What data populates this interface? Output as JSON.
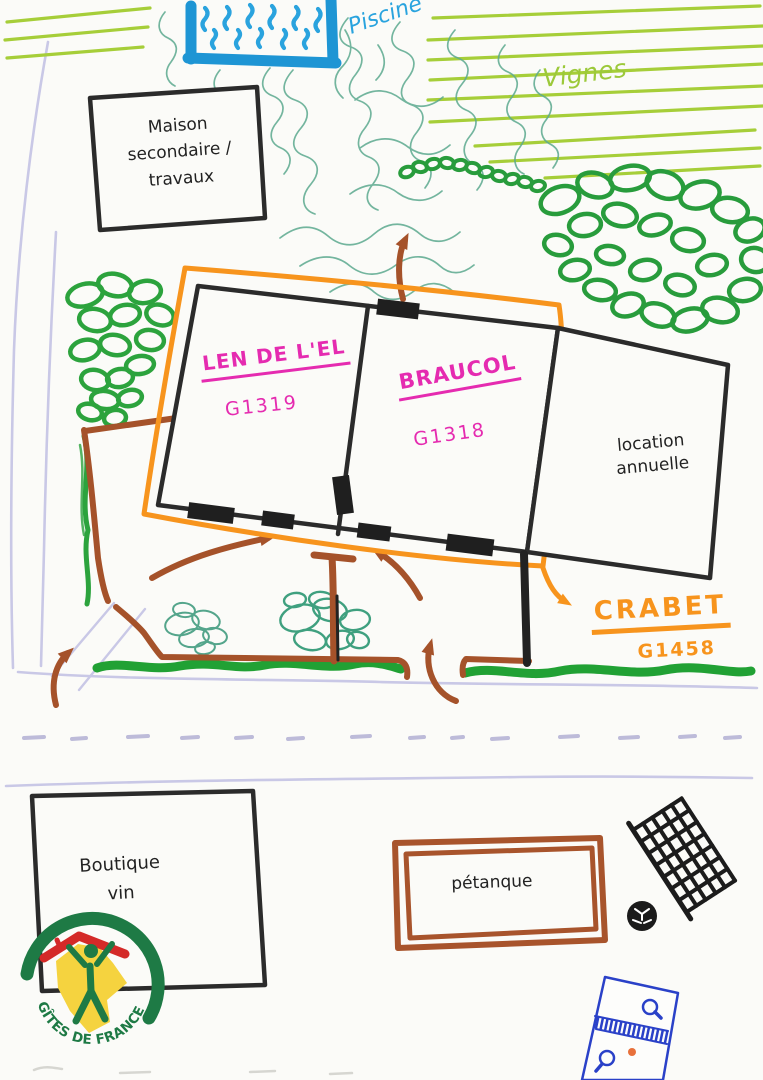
{
  "labels": {
    "pool": "Piscine",
    "vineyard": "Vignes",
    "secondary_house": {
      "line1": "Maison",
      "line2": "secondaire /",
      "line3": "travaux"
    },
    "gite_len": {
      "name": "LEN DE L'EL",
      "code": "G1319"
    },
    "gite_braucol": {
      "name": "BRAUCOL",
      "code": "G1318"
    },
    "gite_crabet": {
      "name": "CRABET",
      "code": "G1458"
    },
    "annual_rental": {
      "line1": "location",
      "line2": "annuelle"
    },
    "wine_shop": {
      "line1": "Boutique",
      "line2": "vin"
    },
    "petanque": "pétanque"
  },
  "logo": {
    "text": "GÎTES DE FRANCE"
  },
  "icons": {
    "pool": "swimming-pool-icon",
    "goal_net": "goal-net-icon",
    "soccer_ball": "soccer-ball-icon",
    "table_tennis": "ping-pong-table-icon",
    "petanque_court": "petanque-court-icon",
    "trees": "tree-icon",
    "hedge": "hedge-icon",
    "direction_arrows": "direction-arrow-icon",
    "logo": "gites-de-france-logo-icon"
  },
  "colors": {
    "boundary_orange": "#F7941D",
    "gite_label_magenta": "#E52BB0",
    "tree_green": "#2CA33D",
    "vine_green": "#A6CE39",
    "pool_blue": "#1E95D4",
    "wall_brown": "#A5522A",
    "road_lavender": "#C9C8E6",
    "table_blue": "#2A41C8",
    "logo_green": "#1E7A45",
    "logo_red": "#D42A28",
    "logo_yellow": "#F5D33F",
    "ink_black": "#2B2B2B"
  }
}
